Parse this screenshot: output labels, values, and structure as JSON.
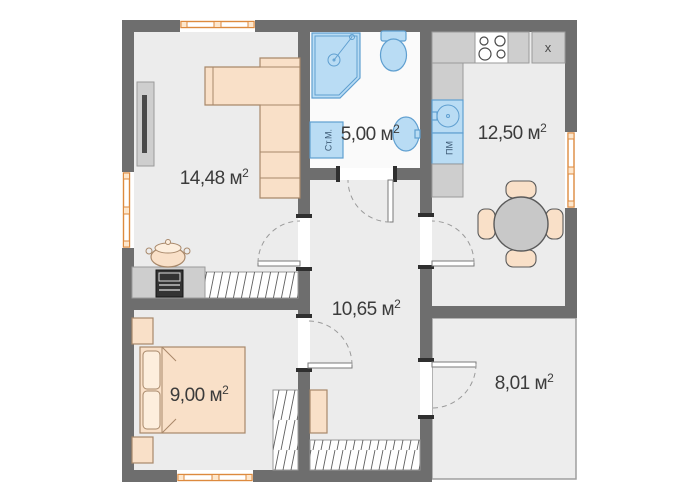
{
  "colors": {
    "wall": "#6e6e6e",
    "floor": "#ececec",
    "floor_bathroom": "#fafafa",
    "floor_storage": "#ededed",
    "furniture_fill": "#f9e0c8",
    "furniture_stroke": "#a8886a",
    "fixture_fill": "#b9dcf4",
    "fixture_stroke": "#5f9fd0",
    "window": "#dd8a3e",
    "counter": "#cecece",
    "counter_stroke": "#9a9a9a",
    "table": "#c8c8c8",
    "hatch": "#5f5f5f",
    "text": "#3b3b3b"
  },
  "rooms": [
    {
      "id": "living-room",
      "area": "14,48 м",
      "sup": "2"
    },
    {
      "id": "bathroom",
      "area": "5,00 м",
      "sup": "2"
    },
    {
      "id": "kitchen",
      "area": "12,50 м",
      "sup": "2"
    },
    {
      "id": "hallway",
      "area": "10,65 м",
      "sup": "2"
    },
    {
      "id": "bedroom",
      "area": "9,00 м",
      "sup": "2"
    },
    {
      "id": "storage",
      "area": "8,01 м",
      "sup": "2"
    }
  ],
  "labels": {
    "washing_machine": "Ст.М.",
    "dishwasher": "ПМ",
    "fridge_marker": "x"
  }
}
